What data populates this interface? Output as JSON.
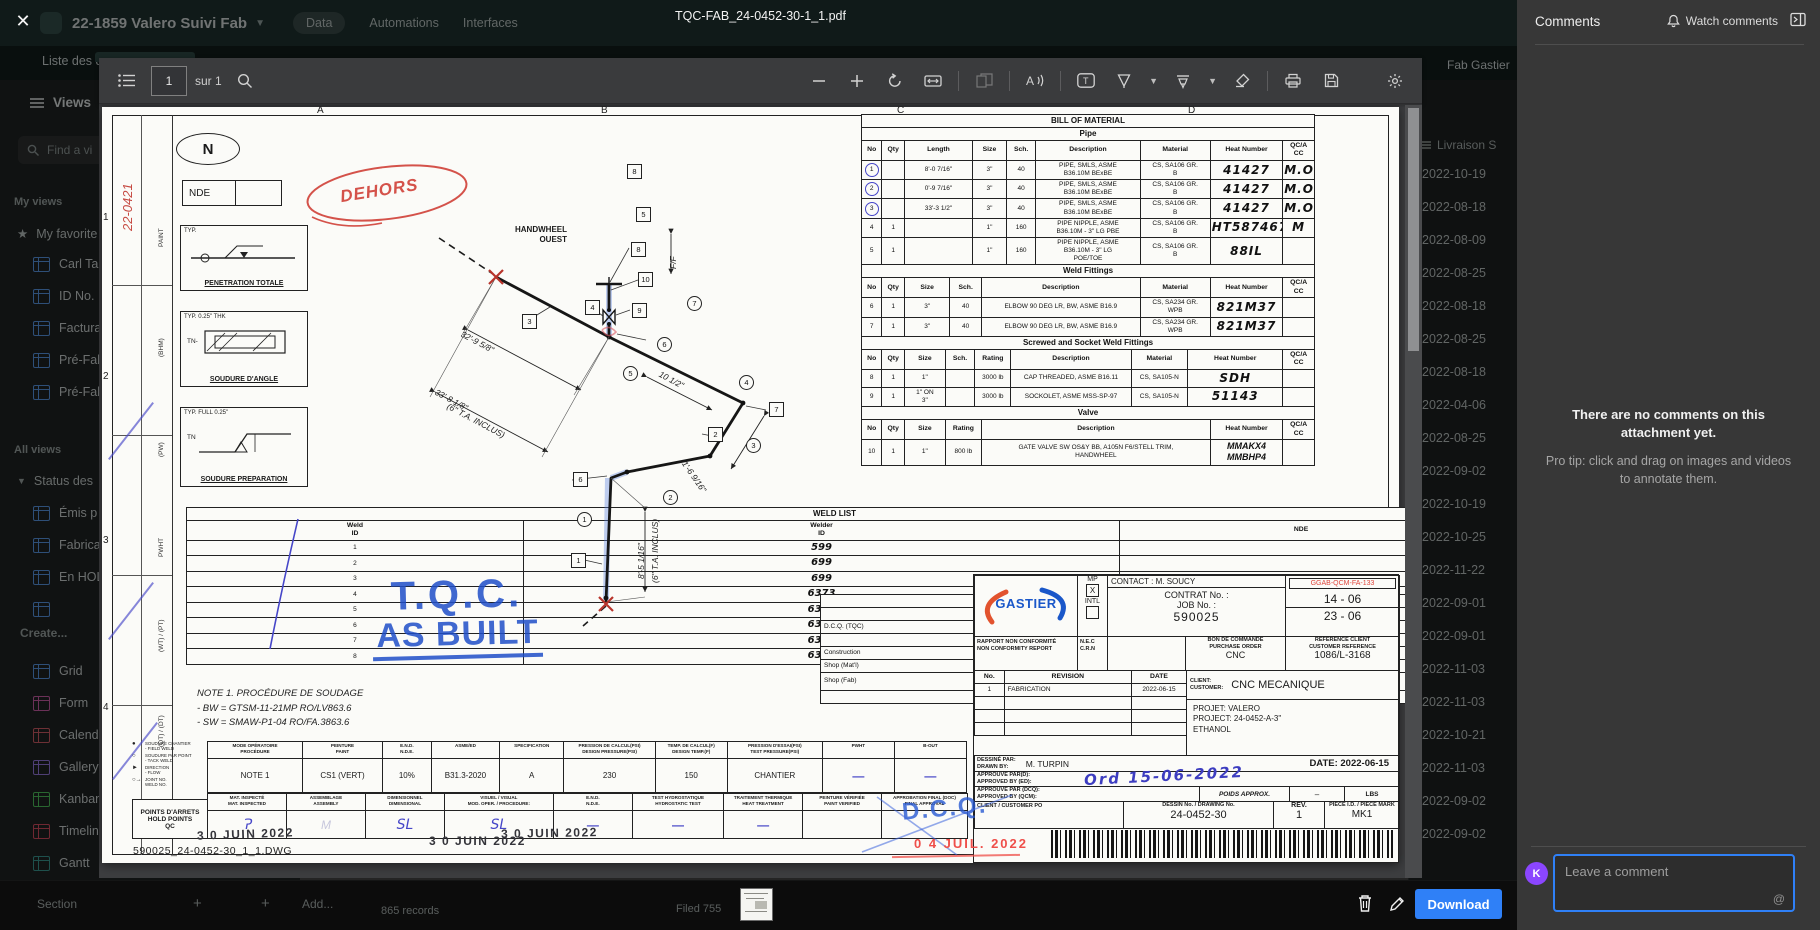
{
  "app": {
    "title": "22-1859 Valero Suivi Fab",
    "tabs": [
      "Data",
      "Automations",
      "Interfaces"
    ],
    "header_right": "Fab Gastier",
    "subnav_left": "Liste des dess",
    "livraison_header": "Livraison S",
    "dates": [
      "2022-10-19",
      "2022-08-18",
      "2022-08-09",
      "2022-08-25",
      "2022-08-18",
      "2022-08-25",
      "2022-08-18",
      "2022-04-06",
      "2022-08-25",
      "2022-09-02",
      "2022-10-19",
      "2022-10-25",
      "2022-11-22",
      "2022-09-01",
      "2022-09-01",
      "2022-11-03",
      "2022-11-03",
      "2022-10-21",
      "2022-11-03",
      "2022-09-02",
      "2022-09-02"
    ],
    "bottom": {
      "section": "Section",
      "plus": "+",
      "add": "Add...",
      "records": "865 records",
      "filed_left": "Filed 755",
      "filed_right": "Filed 738"
    }
  },
  "sidebar": {
    "views": "Views",
    "find_placeholder": "Find a vi",
    "my_views": "My views",
    "favorites": "My favorite",
    "favorite_items": [
      "Carl Ta",
      "ID No.",
      "Factura",
      "Pré-Fab",
      "Pré-Fab"
    ],
    "all_views": "All views",
    "group": "Status des",
    "group_items": [
      "Émis p",
      "Fabrica",
      "En HOL"
    ],
    "create": "Create...",
    "create_items": [
      {
        "label": "Grid",
        "color": "#4e9af5"
      },
      {
        "label": "Form",
        "color": "#dd5ab1"
      },
      {
        "label": "Calendar",
        "color": "#e15864"
      },
      {
        "label": "Gallery",
        "color": "#9b77f0"
      },
      {
        "label": "Kanban",
        "color": "#3fc94f"
      },
      {
        "label": "Timeline",
        "color": "#e8485e"
      },
      {
        "label": "Gantt",
        "color": "#2d9d94"
      }
    ]
  },
  "viewer": {
    "filename": "TQC-FAB_24-0452-30-1_1.pdf",
    "page": "1",
    "page_total": "sur 1",
    "download": "Download"
  },
  "comments": {
    "title": "Comments",
    "watch": "Watch comments",
    "empty_title": "There are no comments on this attachment yet.",
    "empty_tip": "Pro tip: click and drag on images and videos to annotate them.",
    "avatar": "K",
    "placeholder": "Leave a comment",
    "at": "@"
  },
  "drawing": {
    "zones_top": [
      {
        "t": "A",
        "x": 215
      },
      {
        "t": "B",
        "x": 499
      },
      {
        "t": "C",
        "x": 795
      },
      {
        "t": "D",
        "x": 1086
      }
    ],
    "zones_left": [
      {
        "t": "1",
        "y": 105
      },
      {
        "t": "2",
        "y": 264
      },
      {
        "t": "3",
        "y": 428
      },
      {
        "t": "4",
        "y": 595
      }
    ],
    "margin_note": "22-0421",
    "strip_labels": [
      {
        "t": "PAINT",
        "y": 140
      },
      {
        "t": "(BHM)",
        "y": 250
      },
      {
        "t": "(PW)",
        "y": 350
      },
      {
        "t": "PWHT",
        "y": 450
      },
      {
        "t": "(WT) / (PT)",
        "y": 545
      },
      {
        "t": "(QT) / (DT)",
        "y": 640
      }
    ],
    "north": "N",
    "nde_box": "NDE",
    "dehors": "DEHORS",
    "weld_details": [
      {
        "typ": "TYP.",
        "tn": "",
        "caption": "PENETRATION TOTALE"
      },
      {
        "typ": "TYP. 0.25\" THK",
        "tn": "TN-",
        "caption": "SOUDURE D'ANGLE"
      },
      {
        "typ": "TYP. FULL  0.25\"",
        "tn": "TN",
        "caption": "SOUDURE PREPARATION"
      }
    ],
    "weld_list": [
      [
        {
          "t": "WELD LIST",
          "s": 3,
          "c": "sect"
        }
      ],
      [
        {
          "t": "Weld\nID",
          "c": "hd"
        },
        {
          "t": "Welder\nID",
          "c": "hd"
        },
        {
          "t": "NDE",
          "c": "hd"
        }
      ],
      [
        "1",
        {
          "t": "599",
          "c": "hwb"
        },
        ""
      ],
      [
        "2",
        {
          "t": "699",
          "c": "hwb"
        },
        ""
      ],
      [
        "3",
        {
          "t": "699",
          "c": "hwb"
        },
        ""
      ],
      [
        "4",
        {
          "t": "6373",
          "c": "hwb"
        },
        ""
      ],
      [
        "5",
        {
          "t": "6373",
          "c": "hwb"
        },
        ""
      ],
      [
        "6",
        {
          "t": "6373",
          "c": "hwb"
        },
        ""
      ],
      [
        "7",
        {
          "t": "6373",
          "c": "hwb"
        },
        ""
      ],
      [
        "8",
        {
          "t": "6373",
          "c": "hwb"
        },
        ""
      ]
    ],
    "stamp_tqc": "T.Q.C.",
    "stamp_asbuilt": "AS BUILT",
    "note_lines": "NOTE 1. PROCÉDURE DE SOUDAGE\n      -   BW = GTSM-11-21MP RO/LV863.6\n      -   SW = SMAW-P1-04 RO/FA.3863.6",
    "handwheel": "HANDWHEEL\nOUEST",
    "iso_circles": [
      {
        "n": "1",
        "x": 475,
        "y": 405
      },
      {
        "n": "2",
        "x": 561,
        "y": 383
      },
      {
        "n": "3",
        "x": 644,
        "y": 331
      },
      {
        "n": "4",
        "x": 637,
        "y": 268
      },
      {
        "n": "5",
        "x": 521,
        "y": 259
      },
      {
        "n": "6",
        "x": 555,
        "y": 230
      },
      {
        "n": "7",
        "x": 585,
        "y": 189
      }
    ],
    "iso_boxes": [
      {
        "n": "8",
        "x": 525,
        "y": 57
      },
      {
        "n": "5",
        "x": 534,
        "y": 100
      },
      {
        "n": "8",
        "x": 529,
        "y": 135
      },
      {
        "n": "10",
        "x": 536,
        "y": 165
      },
      {
        "n": "4",
        "x": 483,
        "y": 193
      },
      {
        "n": "9",
        "x": 530,
        "y": 196
      },
      {
        "n": "3",
        "x": 420,
        "y": 207
      },
      {
        "n": "2",
        "x": 606,
        "y": 320
      },
      {
        "n": "6",
        "x": 471,
        "y": 365
      },
      {
        "n": "7",
        "x": 667,
        "y": 295
      },
      {
        "n": "1",
        "x": 469,
        "y": 446
      }
    ],
    "dims": [
      {
        "t": "32'-9 5/8\"",
        "x": 362,
        "y": 222,
        "r": 28
      },
      {
        "t": "33'-8 1/8\"",
        "x": 336,
        "y": 280,
        "r": 28
      },
      {
        "t": "(6\" T.A. INCLUS)",
        "x": 348,
        "y": 294,
        "r": 28
      },
      {
        "t": "10 1/2\"",
        "x": 560,
        "y": 262,
        "r": 28
      },
      {
        "t": "1'-6 9/16\"",
        "x": 586,
        "y": 352,
        "r": 55
      },
      {
        "t": "8'-5 1/16\"",
        "x": 534,
        "y": 472,
        "r": -90
      },
      {
        "t": "(6\" T.A. INCLUS)",
        "x": 548,
        "y": 476,
        "r": -90
      },
      {
        "t": "F/F",
        "x": 566,
        "y": 162,
        "r": -90
      }
    ],
    "bom_pipe": [
      [
        {
          "t": "BILL OF MATERIAL",
          "s": 9,
          "c": "sect"
        }
      ],
      [
        {
          "t": "Pipe",
          "s": 9,
          "c": "sect"
        }
      ],
      [
        {
          "t": "No",
          "c": "hd"
        },
        {
          "t": "Qty",
          "c": "hd"
        },
        {
          "t": "Length",
          "c": "hd"
        },
        {
          "t": "Size",
          "c": "hd"
        },
        {
          "t": "Sch.",
          "c": "hd"
        },
        {
          "t": "Description",
          "c": "hd"
        },
        {
          "t": "Material",
          "c": "hd"
        },
        {
          "t": "Heat Number",
          "c": "hd"
        },
        {
          "t": "QC/A\nCC",
          "c": "hd"
        }
      ],
      [
        {
          "t": "1",
          "c": "circ"
        },
        "",
        "8'-0 7/16\"",
        "3\"",
        "40",
        "PIPE, SMLS, ASME\nB36.10M BExBE",
        "CS, SA106 GR.\nB",
        {
          "t": "41427",
          "c": "hwb"
        },
        {
          "t": "M.O",
          "c": "hwb"
        }
      ],
      [
        {
          "t": "2",
          "c": "circ"
        },
        "",
        "0'-9 7/16\"",
        "3\"",
        "40",
        "PIPE, SMLS, ASME\nB36.10M BExBE",
        "CS, SA106 GR.\nB",
        {
          "t": "41427",
          "c": "hwb"
        },
        {
          "t": "M.O",
          "c": "hwb"
        }
      ],
      [
        {
          "t": "3",
          "c": "circ"
        },
        "",
        "33'-3 1/2\"",
        "3\"",
        "40",
        "PIPE, SMLS, ASME\nB36.10M BExBE",
        "CS, SA106 GR.\nB",
        {
          "t": "41427",
          "c": "hwb"
        },
        {
          "t": "M.O",
          "c": "hwb"
        }
      ],
      [
        "4",
        "1",
        "",
        "1\"",
        "160",
        "PIPE NIPPLE, ASME\nB36.10M - 3\" LG PBE",
        "CS, SA106 GR.\nB",
        {
          "t": "HT587467",
          "c": "hwr"
        },
        {
          "t": "M",
          "c": "hwr"
        }
      ],
      [
        "5",
        "1",
        "",
        "1\"",
        "160",
        "PIPE NIPPLE, ASME\nB36.10M - 3\" LG\nPOE/TOE",
        "CS, SA106 GR.\nB",
        {
          "t": "88IL",
          "c": "hwr"
        },
        ""
      ]
    ],
    "bom_weld": [
      [
        {
          "t": "Weld Fittings",
          "s": 8,
          "c": "sect"
        }
      ],
      [
        {
          "t": "No",
          "c": "hd"
        },
        {
          "t": "Qty",
          "c": "hd"
        },
        {
          "t": "Size",
          "c": "hd"
        },
        {
          "t": "Sch.",
          "c": "hd"
        },
        {
          "t": "Description",
          "c": "hd"
        },
        {
          "t": "Material",
          "c": "hd"
        },
        {
          "t": "Heat Number",
          "c": "hd"
        },
        {
          "t": "QC/A\nCC",
          "c": "hd"
        }
      ],
      [
        "6",
        "1",
        "3\"",
        "40",
        "ELBOW 90 DEG LR, BW, ASME B16.9",
        "CS, SA234 GR.\nWPB",
        {
          "t": "821M37",
          "c": "hwr"
        },
        ""
      ],
      [
        "7",
        "1",
        "3\"",
        "40",
        "ELBOW 90 DEG LR, BW, ASME B16.9",
        "CS, SA234 GR.\nWPB",
        {
          "t": "821M37",
          "c": "hwr"
        },
        ""
      ]
    ],
    "bom_screwed": [
      [
        {
          "t": "Screwed and Socket Weld Fittings",
          "s": 9,
          "c": "sect"
        }
      ],
      [
        {
          "t": "No",
          "c": "hd"
        },
        {
          "t": "Qty",
          "c": "hd"
        },
        {
          "t": "Size",
          "c": "hd"
        },
        {
          "t": "Sch.",
          "c": "hd"
        },
        {
          "t": "Rating",
          "c": "hd"
        },
        {
          "t": "Description",
          "c": "hd"
        },
        {
          "t": "Material",
          "c": "hd"
        },
        {
          "t": "Heat Number",
          "c": "hd"
        },
        {
          "t": "QC/A\nCC",
          "c": "hd"
        }
      ],
      [
        "8",
        "1",
        "1\"",
        "",
        "3000 lb",
        "CAP THREADED, ASME B16.11",
        "CS, SA105-N",
        {
          "t": "SDH",
          "c": "hwr"
        },
        ""
      ],
      [
        "9",
        "1",
        "1\" ON\n3\"",
        "",
        "3000 lb",
        "SOCKOLET, ASME MSS-SP-97",
        "CS, SA105-N",
        {
          "t": "51143",
          "c": "hwr"
        },
        ""
      ]
    ],
    "bom_valve": [
      [
        {
          "t": "Valve",
          "s": 7,
          "c": "sect"
        }
      ],
      [
        {
          "t": "No",
          "c": "hd"
        },
        {
          "t": "Qty",
          "c": "hd"
        },
        {
          "t": "Size",
          "c": "hd"
        },
        {
          "t": "Rating",
          "c": "hd"
        },
        {
          "t": "Description",
          "c": "hd"
        },
        {
          "t": "Heat Number",
          "c": "hd"
        },
        {
          "t": "QC/A\nCC",
          "c": "hd"
        }
      ],
      [
        "10",
        "1",
        "1\"",
        "800 lb",
        "GATE VALVE SW OS&Y BB, A105N F6/STELL TRIM,\nHANDWHEEL",
        {
          "t": "MMAKX4\nMMBHP4",
          "c": "hwr9"
        },
        ""
      ]
    ],
    "transmission": [
      [
        {
          "t": "TRANSMISSION",
          "s": 4,
          "c": "sect"
        }
      ],
      [
        {
          "t": "DEPT.",
          "c": "hd"
        },
        {
          "t": "F",
          "c": "hd"
        },
        {
          "t": "P",
          "c": "hd"
        },
        {
          "t": "VD",
          "c": "hd"
        }
      ],
      [
        {
          "t": "D.C.Q.  (TQC)",
          "c": "left"
        },
        "",
        "",
        ""
      ],
      [
        "D.I.",
        "",
        "",
        ""
      ],
      [
        {
          "t": "Construction",
          "c": "left"
        },
        "",
        "",
        ""
      ],
      [
        {
          "t": "Shop  (Mat'l)",
          "c": "left"
        },
        "",
        "",
        ""
      ],
      [
        {
          "t": "Shop  (Fab)",
          "c": "left"
        },
        {
          "t": "1",
          "c": "hwb circ"
        },
        "",
        ""
      ],
      [
        "Client",
        "",
        "",
        ""
      ]
    ],
    "title_block": {
      "gastier": "GASTIER",
      "mp": "MP",
      "mp_mark": "X",
      "intl": "INTL",
      "contact": "CONTACT : M. SOUCY",
      "contrat": "CONTRAT  No.  :",
      "job": "JOB  No.  :",
      "job_no": "590025",
      "code_red": "GGAB-QCM-FA-133",
      "n1": "14   -   06",
      "n2": "23   -   06",
      "rapport": "RAPPORT NON CONFORMITÉ\nNON CONFORMITY REPORT",
      "nec": "N.E.C\nC.R.N",
      "bon": "BON DE COMMANDE\nPURCHASE ORDER",
      "bon_val": "CNC",
      "refclient": "RÉFÉRENCE CLIENT\nCUSTOMER REFERENCE",
      "ref_val": "1086/L-3168",
      "revision_rows": [
        [
          {
            "t": "No.",
            "c": "hd"
          },
          {
            "t": "REVISION",
            "c": "hd"
          },
          {
            "t": "DATE",
            "c": "hd"
          }
        ],
        [
          "1",
          {
            "t": "FABRICATION",
            "c": "left"
          },
          "2022-06-15"
        ],
        [
          "",
          "",
          ""
        ],
        [
          "",
          "",
          ""
        ],
        [
          "",
          "",
          ""
        ]
      ],
      "client_lbl": "CLIENT:\nCUSTOMER:",
      "client_val": "CNC  MECANIQUE",
      "projet": "PROJET: VALERO\nPROJECT: 24-0452-A-3\"\n              ETHANOL",
      "drawn_lbl": "DESSINÉ PAR:\nDRAWN BY:",
      "drawn_val": "M. TURPIN",
      "date_lbl": "DATE: 2022-06-15",
      "app1": "APPROUVÉ PAR(D):\nAPPROVED BY (ED):",
      "app1_hw": "Ord  15-06-2022",
      "app2": "APPROUVÉ PAR (DCQ):\nAPPROVED BY (QCM):",
      "poids": "POIDS APPROX.",
      "poids_val": "–",
      "lbs": "LBS",
      "po": "CLIENT / CUSTOMER PO",
      "dessin": "DESSIN No. / DRAWING No.",
      "dessin_val": "24-0452-30",
      "rev": "REV.",
      "rev_val": "1",
      "piece": "PIÈCE I.D. / PIECE MARK",
      "piece_val": "MK1"
    },
    "qc_row1": [
      {
        "h": "MODE OPÉRATOIRE\nPROCÉDURE",
        "v": "NOTE 1"
      },
      {
        "h": "PEINTURE\nPAINT",
        "v": "CS1  (VERT)"
      },
      {
        "h": "E.N.D.\nN.D.E.",
        "v": "10%"
      },
      {
        "h": "ASME/ED",
        "v": "B31.3-2020"
      },
      {
        "h": "SPECIFICATION",
        "v": "A"
      },
      {
        "h": "PRESSION DE CALCUL(PSI)\nDESIGN PRESSURE(PSI)",
        "v": "230"
      },
      {
        "h": "TEMP. DE CALCUL(F)\nDESIGN TEMP.(F)",
        "v": "150"
      },
      {
        "h": "PRESSION D'ESSAI(PSI)\nTEST PRESSURE(PSI)",
        "v": "CHANTIER"
      },
      {
        "h": "PWHT",
        "v": "—",
        "c": "dash"
      },
      {
        "h": "B-OUT",
        "v": "—",
        "c": "dash"
      }
    ],
    "qc_row2": [
      {
        "h": "MAT. INSPECTÉ\nMAT. INSPECTED",
        "v": "Ɂ",
        "c": "sig"
      },
      {
        "h": "ASSEMBLAGE\nASSEMBLY",
        "v": "M",
        "c": "sigf"
      },
      {
        "h": "DIMENSIONNEL\nDIMENSIONAL",
        "v": "SL",
        "c": "sig"
      },
      {
        "h": "VISUEL / VISUAL\nMOD. OPER. / PROCEDURE:",
        "v": "SL",
        "c": "sig"
      },
      {
        "h": "E.N.D.\nN.D.E.",
        "v": "—",
        "c": "dash"
      },
      {
        "h": "TEST HYDROSTATIQUE\nHYDROSTATIC TEST",
        "v": "—",
        "c": "dash"
      },
      {
        "h": "TRAITEMENT THERMIQUE\nHEAT TREATMENT",
        "v": "—",
        "c": "dash"
      },
      {
        "h": "PEINTURE VÉRIFIÉE\nPAINT VERIFIED",
        "v": ""
      },
      {
        "h": "APPROBATION FINAL  (DOC)\nFINAL APPROVAL",
        "v": ""
      }
    ],
    "legend_items": [
      {
        "sym": "●",
        "t": "SOUDURE CHANTIER\n- FIELD WELD"
      },
      {
        "sym": "○",
        "t": "SOUDURE PAR POINT\n- TACK WELD"
      },
      {
        "sym": "►",
        "t": "DIRECTION\n- FLOW"
      },
      {
        "sym": "○→",
        "t": "JOINT NO.\nWELD NO."
      }
    ],
    "hold_label": "POINTS D'ARRETS\nHOLD POINTS\nQC",
    "stamps": {
      "juin": "3 0  JUIN  2022",
      "dcq": "D.C.Q.",
      "juil": "0 4  JUIL.  2022"
    },
    "dwg": "590025_24-0452-30_1_1.DWG"
  }
}
